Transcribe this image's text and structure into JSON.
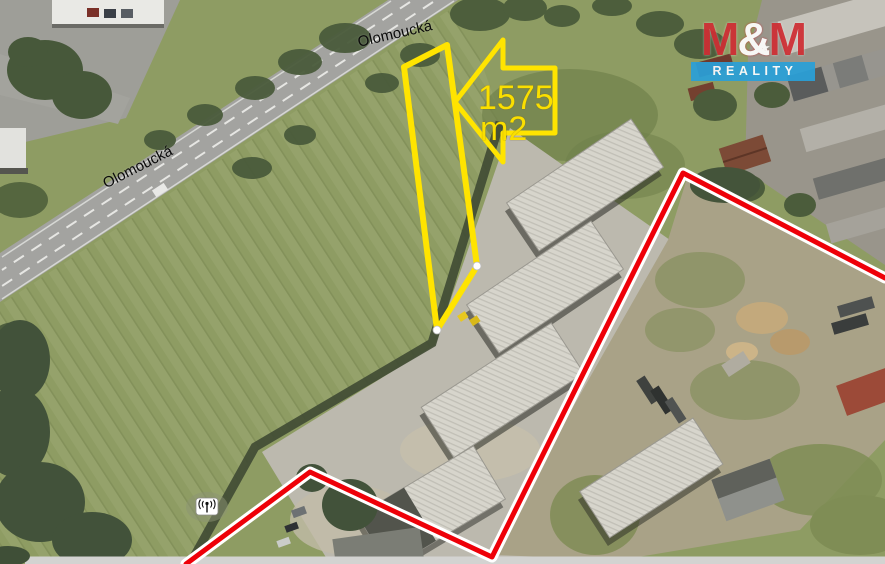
{
  "map": {
    "street_label_top": "Olomoucká",
    "street_label_left": "Olomoucká",
    "area_annotation": {
      "line1": "1575",
      "line2": "m2"
    },
    "icons": [
      {
        "name": "antenna-icon"
      },
      {
        "name": "arrow-left-icon"
      }
    ]
  },
  "annotations": {
    "parcel_outline_color": "#ffe400",
    "boundary_color": "#ee0008",
    "boundary_casing_color": "#ffffff",
    "vertex_dot_color": "#ffffff"
  },
  "logo": {
    "m_left": "M",
    "amp": "&",
    "m_right": "M",
    "star": "★",
    "subtitle": "REALITY",
    "color_red": "#cf2e34",
    "color_blue": "#2aa0d8"
  }
}
